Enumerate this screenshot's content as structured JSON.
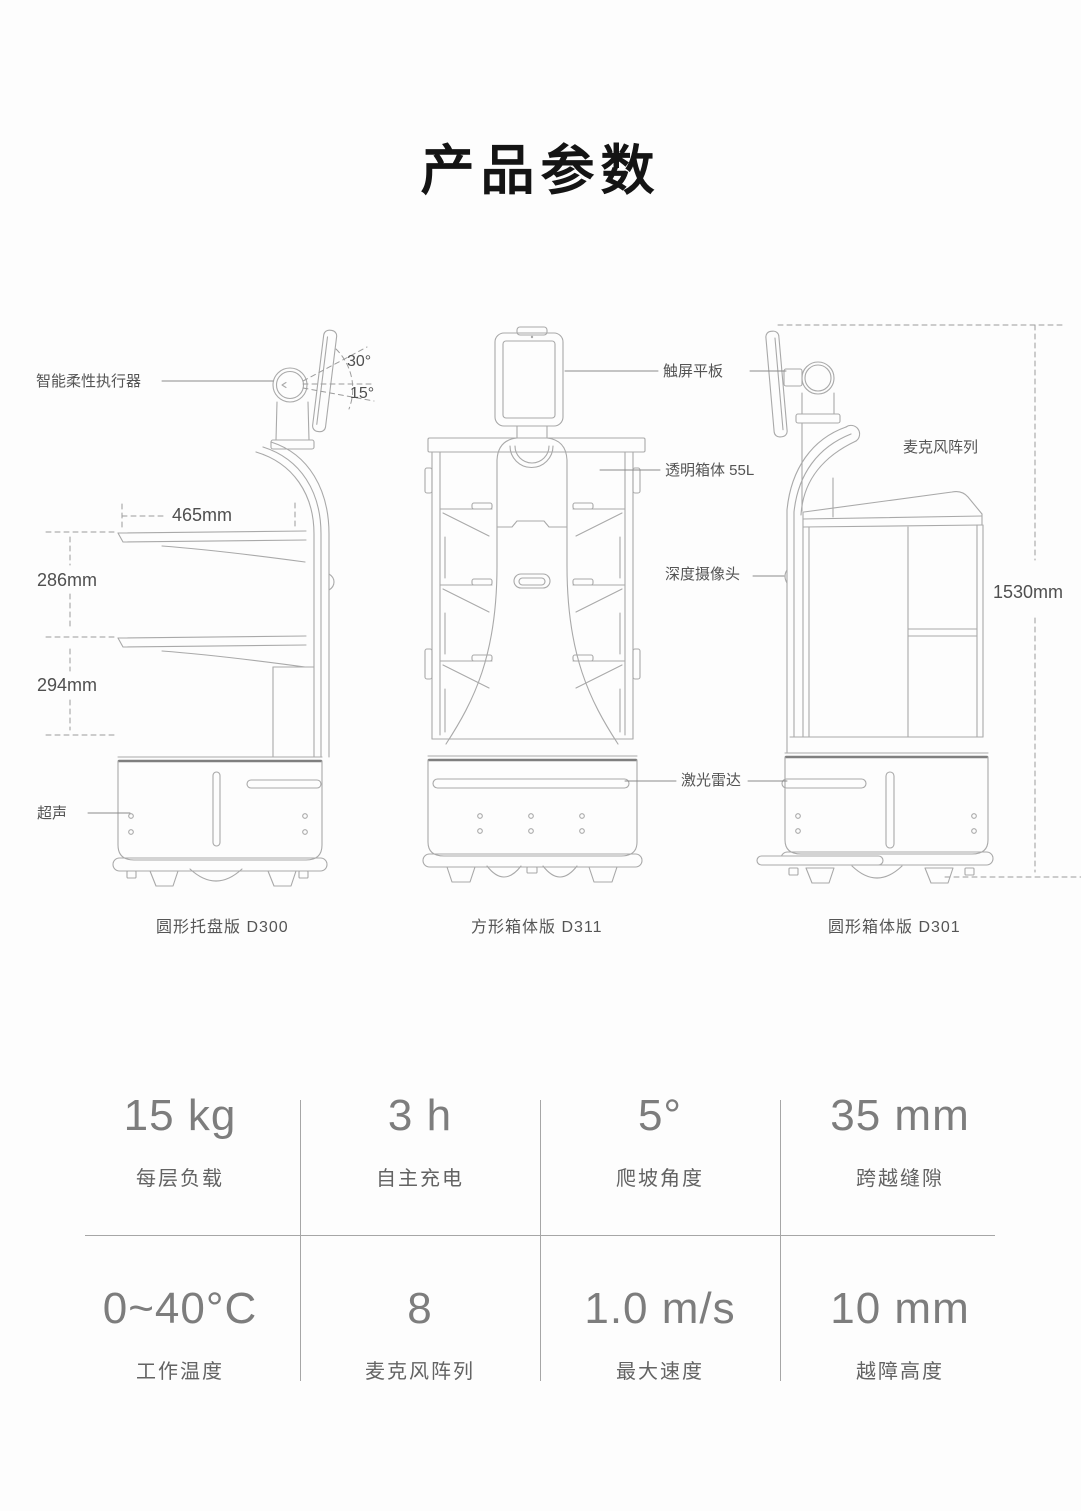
{
  "title": "产品参数",
  "colors": {
    "background": "#fdfdfd",
    "line_art": "#a9a9a9",
    "accent_band": "#7f7f7f",
    "label_text": "#545454",
    "spec_value_text": "#7d7d7d",
    "spec_label_text": "#636363",
    "divider": "#a6a6a6",
    "title_text": "#141414"
  },
  "diagram": {
    "annotations": {
      "actuator": "智能柔性执行器",
      "tilt_up": "30°",
      "tilt_down": "15°",
      "tray_width": "465mm",
      "tray_gap_upper": "286mm",
      "tray_gap_lower": "294mm",
      "ultrasonic": "超声",
      "touchscreen": "触屏平板",
      "transparent_cabinet": "透明箱体 55L",
      "depth_camera": "深度摄像头",
      "lidar": "激光雷达",
      "mic_array": "麦克风阵列",
      "total_height": "1530mm"
    },
    "captions": [
      {
        "label": "圆形托盘版 D300"
      },
      {
        "label": "方形箱体版 D311"
      },
      {
        "label": "圆形箱体版 D301"
      }
    ]
  },
  "specs": {
    "items": [
      {
        "value": "15 kg",
        "label": "每层负载"
      },
      {
        "value": "3 h",
        "label": "自主充电"
      },
      {
        "value": "5°",
        "label": "爬坡角度"
      },
      {
        "value": "35 mm",
        "label": "跨越缝隙"
      },
      {
        "value": "0~40°C",
        "label": "工作温度"
      },
      {
        "value": "8",
        "label": "麦克风阵列"
      },
      {
        "value": "1.0 m/s",
        "label": "最大速度"
      },
      {
        "value": "10 mm",
        "label": "越障高度"
      }
    ]
  }
}
